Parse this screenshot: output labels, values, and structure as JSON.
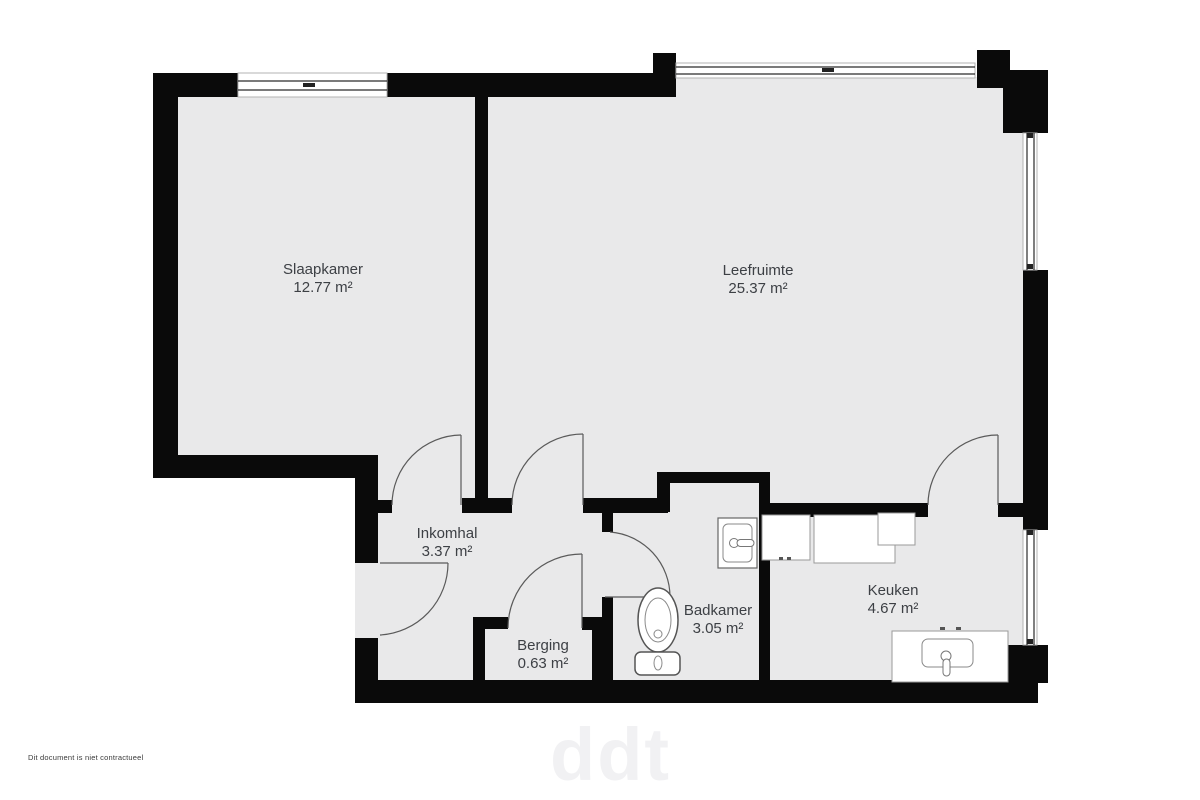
{
  "document": {
    "disclaimer": "Dit document is niet contractueel",
    "watermark": "ddt"
  },
  "rooms": [
    {
      "id": "slaapkamer",
      "name": "Slaapkamer",
      "area": "12.77 m²"
    },
    {
      "id": "leefruimte",
      "name": "Leefruimte",
      "area": "25.37 m²"
    },
    {
      "id": "inkomhal",
      "name": "Inkomhal",
      "area": "3.37 m²"
    },
    {
      "id": "berging",
      "name": "Berging",
      "area": "0.63 m²"
    },
    {
      "id": "badkamer",
      "name": "Badkamer",
      "area": "3.05 m²"
    },
    {
      "id": "keuken",
      "name": "Keuken",
      "area": "4.67 m²"
    }
  ],
  "fixtures": [
    "toilet",
    "bathroom-sink",
    "kitchen-counter",
    "kitchen-sink"
  ],
  "openings": {
    "windows": 4,
    "doors": [
      "entrance",
      "slaapkamer",
      "leefruimte",
      "berging",
      "badkamer",
      "keuken"
    ]
  },
  "colors": {
    "wall": "#0a0a0a",
    "floor": "#e9e9ea",
    "background": "#ffffff",
    "label_text": "#3d4045",
    "door_line": "#5a5a5a"
  }
}
